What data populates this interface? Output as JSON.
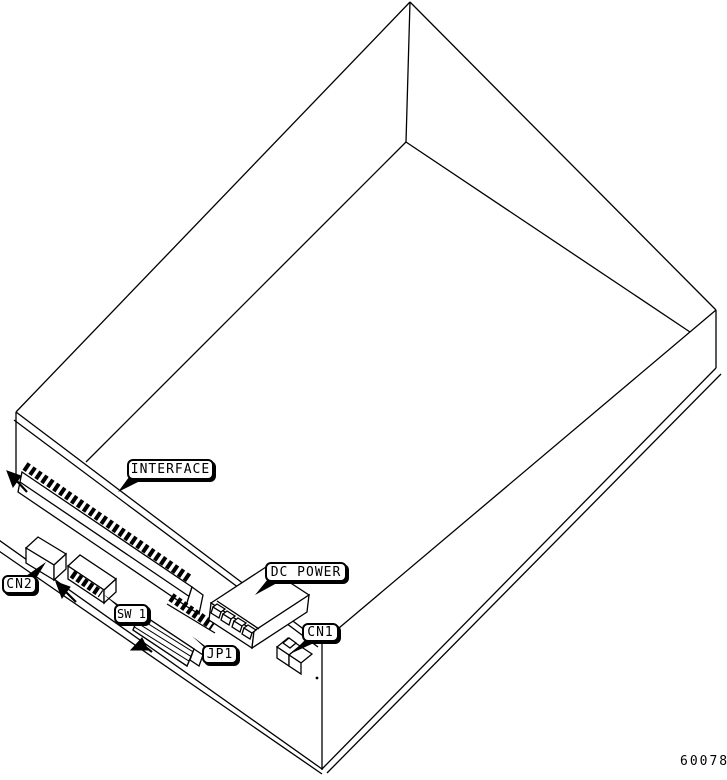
{
  "figure": {
    "kind": "isometric-hardware-diagram",
    "background_color": "#ffffff",
    "line_color": "#000000",
    "part_number": "60078",
    "callouts": [
      {
        "id": "interface",
        "text": "INTERFACE"
      },
      {
        "id": "cn2",
        "text": "CN2"
      },
      {
        "id": "sw1",
        "text": "SW 1"
      },
      {
        "id": "jp1",
        "text": "JP1"
      },
      {
        "id": "dc-power",
        "text": "DC POWER"
      },
      {
        "id": "cn1",
        "text": "CN1"
      }
    ]
  }
}
